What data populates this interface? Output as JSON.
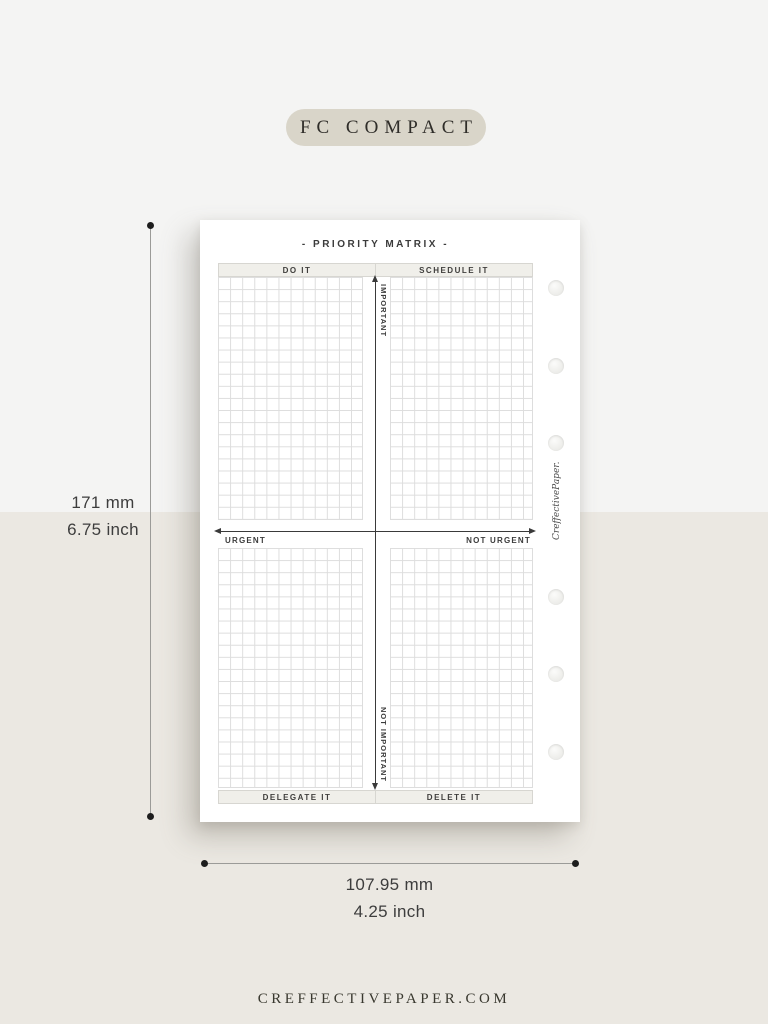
{
  "badge": {
    "label": "FC COMPACT"
  },
  "paper": {
    "title": "- PRIORITY MATRIX -",
    "quadrants": {
      "top_left": {
        "header": "DO IT"
      },
      "top_right": {
        "header": "SCHEDULE IT"
      },
      "bottom_left": {
        "footer": "DELEGATE IT"
      },
      "bottom_right": {
        "footer": "DELETE IT"
      }
    },
    "axes": {
      "vertical_top": "IMPORTANT",
      "vertical_bottom": "NOT IMPORTANT",
      "horizontal_left": "URGENT",
      "horizontal_right": "NOT URGENT"
    },
    "branding": "CreffectivePaper.",
    "hole_count": 6
  },
  "dimensions": {
    "height": {
      "mm": "171 mm",
      "inch": "6.75 inch"
    },
    "width": {
      "mm": "107.95 mm",
      "inch": "4.25 inch"
    }
  },
  "footer": {
    "website": "CREFFECTIVEPAPER.COM"
  },
  "colors": {
    "bg_top": "#f4f4f3",
    "bg_bottom": "#ebe8e2",
    "badge_bg": "#d9d5c9",
    "paper": "#ffffff",
    "grid_line": "#dddddd",
    "bar_fill": "#f0efea",
    "bar_border": "#d7d6d1",
    "ink": "#3a3a3a",
    "axis": "#3a3a3a",
    "dim_line": "#9b9b98",
    "dim_dot": "#1d1d1d"
  }
}
